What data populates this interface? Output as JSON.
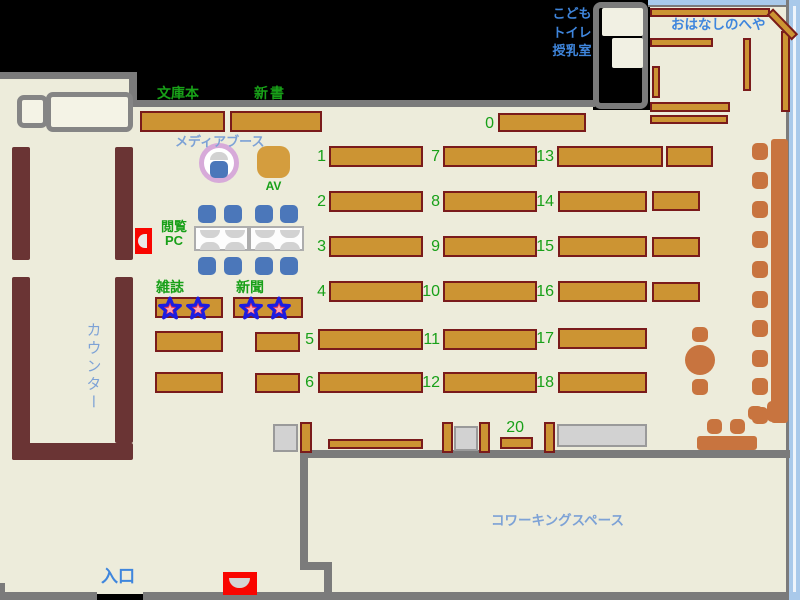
{
  "type": "library-floor-map",
  "legend": {
    "counter": "カウンター",
    "entrance": "入口",
    "coworking_space": "コワーキングスペース",
    "story_room": "おはなしのへや",
    "kids": "こども",
    "toilet": "トイレ",
    "nursing_room": "授乳室",
    "paperbacks": "文庫本",
    "new_books": "新書",
    "media_booth": "メディアブース",
    "av": "AV",
    "reading_pc_line1": "閲覧",
    "reading_pc_line2": "PC",
    "magazines": "雑誌",
    "newspapers": "新聞"
  },
  "shelf_numbers": [
    "0",
    "1",
    "2",
    "3",
    "4",
    "5",
    "6",
    "7",
    "8",
    "9",
    "10",
    "11",
    "12",
    "13",
    "14",
    "15",
    "16",
    "17",
    "18",
    "20"
  ],
  "colors": {
    "floor": "#edecdb",
    "wall_gray": "#7b7b7b",
    "shelf_fill": "#cc9433",
    "shelf_border": "#7a1b1b",
    "counter_brown": "#6a3434",
    "bench_orange": "#c8743f",
    "chair_blue": "#4b77ba",
    "number_green": "#18a018",
    "label_blue": "#7da2d6",
    "label_blue_bright": "#3f86dd",
    "window_blue": "#a9c9ea",
    "alert_red": "#f90500",
    "media_ring_pink": "#d7aad9",
    "av_tan": "#d49d3e"
  }
}
